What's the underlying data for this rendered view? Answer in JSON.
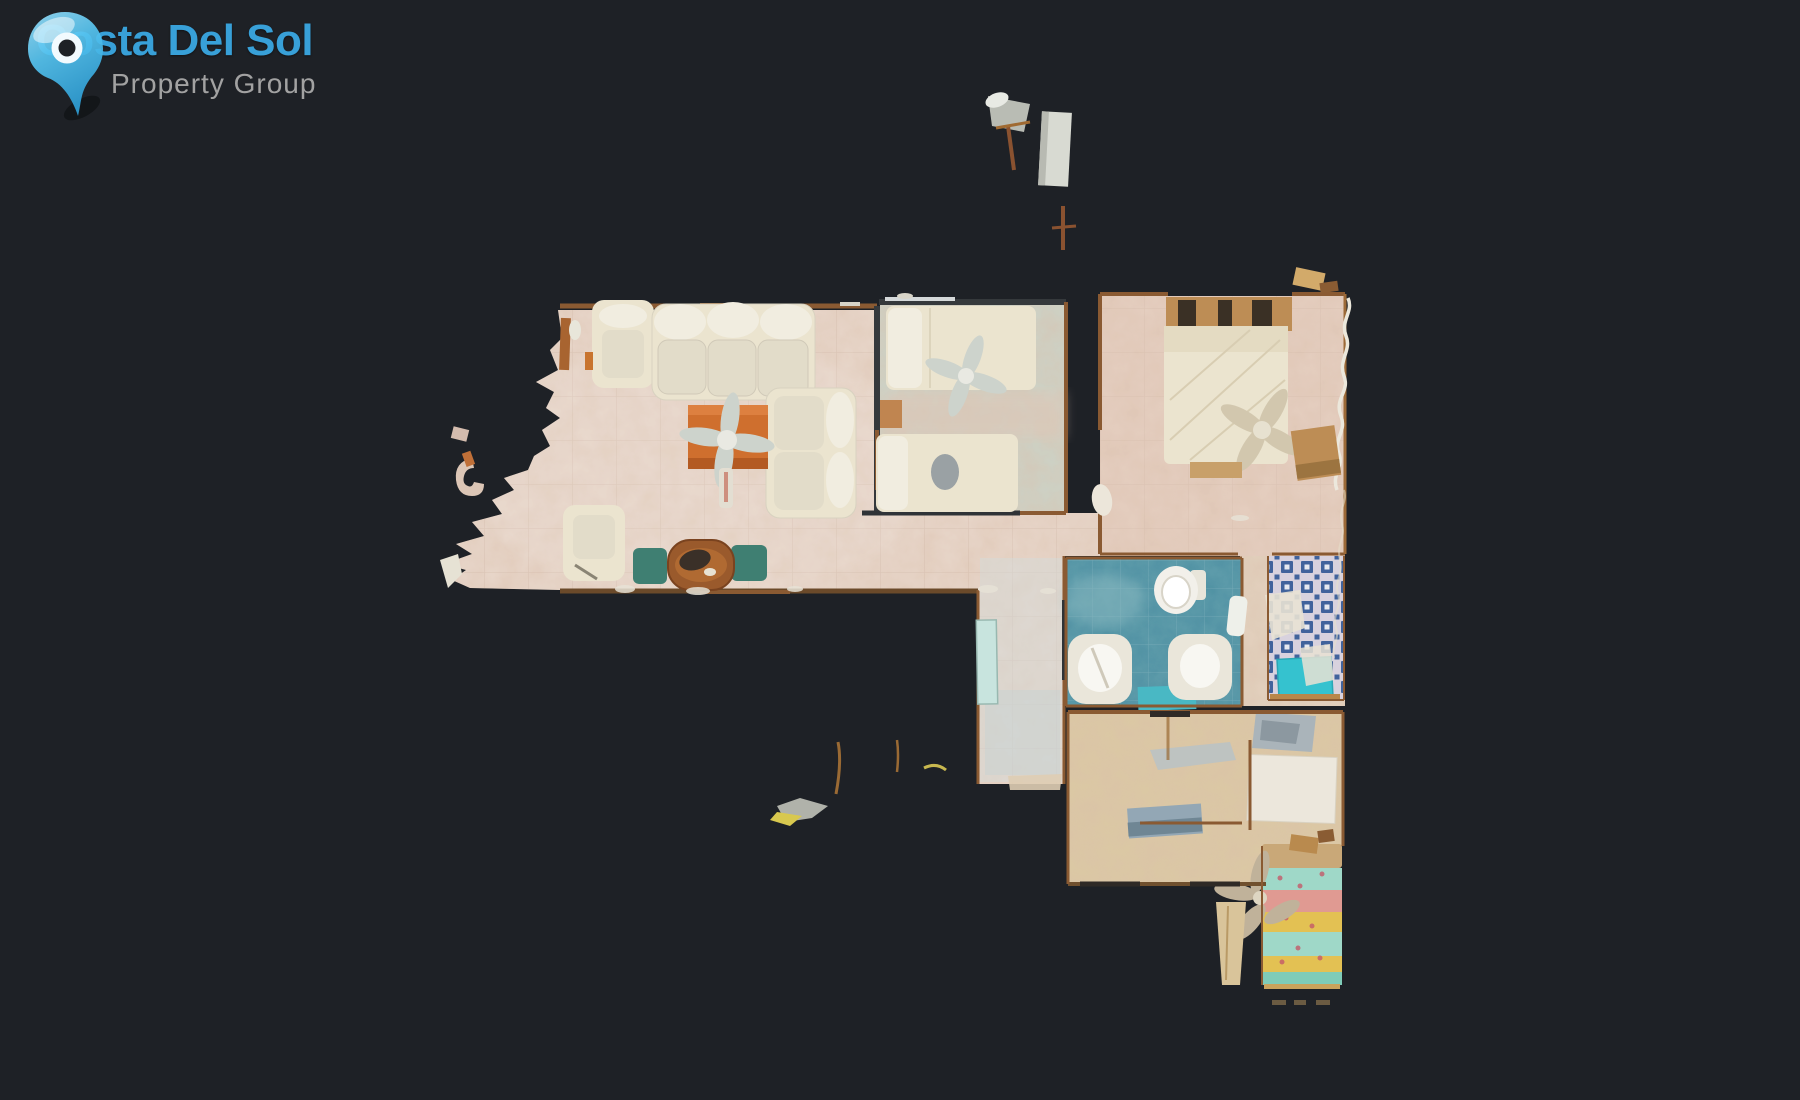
{
  "meta": {
    "background": "#1e2126",
    "view_label": "top-down dollhouse scan of apartment"
  },
  "logo": {
    "title": "Costa Del Sol",
    "subtitle": "Property Group",
    "colors": {
      "title": "#38a0d8",
      "subtitle": "#a2a2a2",
      "pin_light": "#9be0fa",
      "pin_mid": "#55c3ef",
      "pin_dark": "#2f9fd6",
      "pin_ring": "#f2fafe",
      "pin_hole": "#1e2126"
    }
  },
  "floorplan": {
    "colors": {
      "wall_wood": "#8a5a32",
      "wall_dark": "#35393c",
      "furniture_cream": "#ebe4cf",
      "cushion_white": "#f1ede0",
      "seat_shade": "#e2dcc9",
      "rug_orange": "#cf6f2e",
      "cushion_green": "#3f7f72",
      "table_wood": "#9a5a2c",
      "fan_gray": "#cdd3cc",
      "fan_tan": "#d2c7ae",
      "fan_bronze": "#c0b29a",
      "headboard_wood": "#bd8d55",
      "fragment_gray": "#b9bcb4",
      "fragment_white": "#d8dad2"
    },
    "rooms": [
      {
        "id": "living-room",
        "floor": "#e8d7cb"
      },
      {
        "id": "bedroom-1",
        "floor": "#ccd3c7"
      },
      {
        "id": "bedroom-2",
        "floor": "#e5cfc1"
      },
      {
        "id": "bathroom-1",
        "floor": "#4f91a3"
      },
      {
        "id": "bathroom-2",
        "floor": "#d8d2de",
        "tile": "#41639c",
        "mat": "#35c2cf"
      },
      {
        "id": "kitchen",
        "floor": "#dbc9a4"
      },
      {
        "id": "corridor",
        "floor": "#d3dbdb",
        "door": "#c8e4de"
      },
      {
        "id": "vestibule",
        "floor": "#e3d2bf"
      }
    ],
    "bed3_stripes": [
      {
        "color": "#c9a878"
      },
      {
        "color": "#9fd8c8"
      },
      {
        "color": "#e09a92"
      },
      {
        "color": "#e3c153"
      },
      {
        "color": "#9fd8c8"
      },
      {
        "color": "#e3c153"
      },
      {
        "color": "#7fccb8"
      }
    ]
  }
}
